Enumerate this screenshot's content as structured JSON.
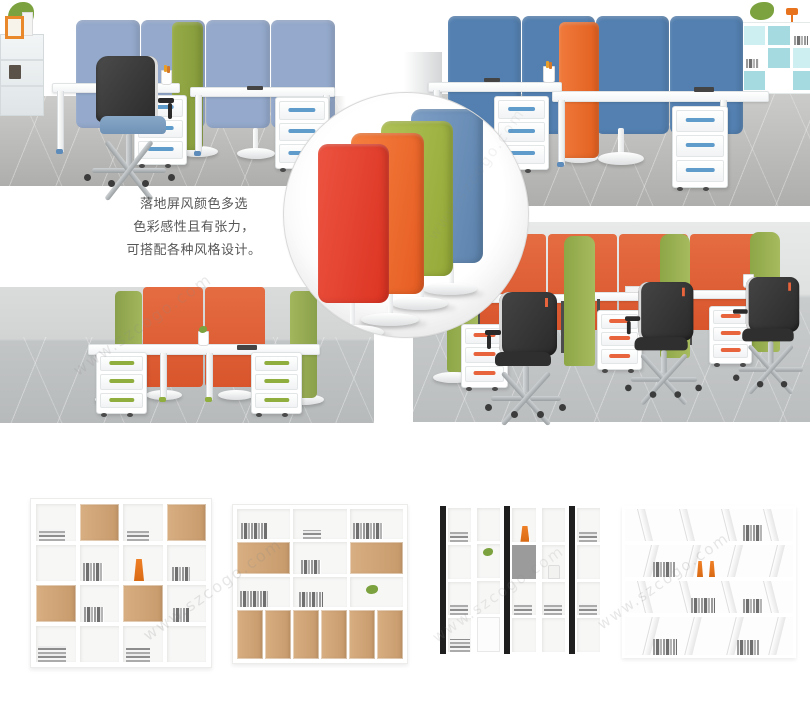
{
  "page": {
    "background": "#ffffff",
    "watermark": "www.szcogo.com"
  },
  "description": {
    "line1": "落地屏风颜色多选",
    "line2": "色彩感性且有张力，",
    "line3": "可搭配各种风格设计。"
  },
  "palette": {
    "screen_red": "#dc3322",
    "screen_orange": "#e65c22",
    "screen_green": "#93a837",
    "screen_blue": "#5c83ad",
    "panel_blue_light": "#94a9cc",
    "panel_blue_deep": "#5380b1",
    "panel_olive": "#8ea342",
    "panel_orange": "#ec6e33",
    "divider_green": "#9cb558",
    "back_panel_orange": "#e2663e",
    "teal_cube_shelf": "#a5dbe0",
    "wood": "#cda273",
    "floor_gray": "#b8b8b6",
    "wall_gray": "#d8dada",
    "drawer_handle_blue": "#5f9bcb",
    "drawer_handle_green": "#8fae3e",
    "drawer_handle_orange": "#e8643c",
    "caption_text": "#575757"
  }
}
